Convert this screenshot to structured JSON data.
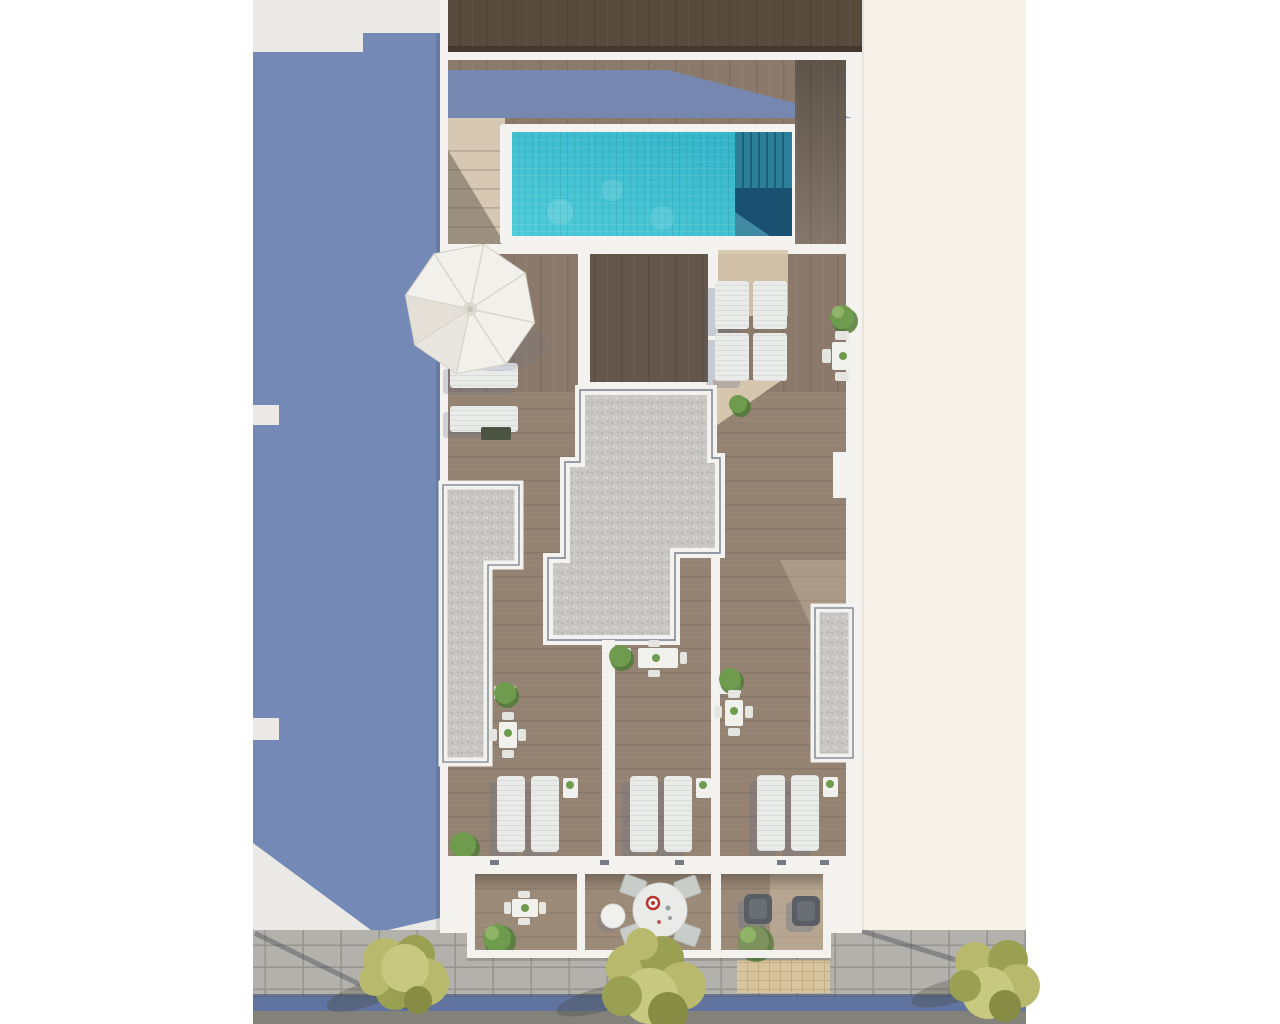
{
  "scene": {
    "description": "Aerial top-down 3D render of a residential building rooftop with swimming pool, terraces, balconies and street below",
    "objects": [
      {
        "name": "swimming-pool",
        "count": 1
      },
      {
        "name": "pool-steps-ledge",
        "count": 1
      },
      {
        "name": "stair-flight",
        "count": 1
      },
      {
        "name": "parasol",
        "count": 1
      },
      {
        "name": "sun-lounger",
        "count": 12
      },
      {
        "name": "gravel-roof-section",
        "count": 1
      },
      {
        "name": "gravel-planter-strip",
        "count": 2
      },
      {
        "name": "terrace",
        "count": 3
      },
      {
        "name": "balcony",
        "count": 3
      },
      {
        "name": "round-dining-table",
        "count": 1
      },
      {
        "name": "square-dining-table",
        "count": 5
      },
      {
        "name": "lounge-chair-dark",
        "count": 2
      },
      {
        "name": "potted-plant",
        "count": 10
      },
      {
        "name": "street-tree",
        "count": 3
      },
      {
        "name": "sidewalk",
        "count": 1
      },
      {
        "name": "street-asphalt",
        "count": 1
      },
      {
        "name": "adjacent-building-shadow",
        "count": 1
      }
    ]
  },
  "palette": {
    "page_bg": "#ffffff",
    "left_col": "#eae9e6",
    "shadow_blue": "#7489b6",
    "wall": "#f3f2ee",
    "dark_wood": "#584a3d",
    "dark_wood2": "#63564a",
    "deck_wood": "#8b7a6b",
    "terrace_wood": "#9c8a78",
    "beige": "#d7c6ae",
    "stairs": "#d7c8b3",
    "pool_light": "#4fccd9",
    "pool_main": "#2fb1c5",
    "pool_ledge": "#2b7f98",
    "pool_ledge_line": "#1d6078",
    "pool_deep": "#1a5070",
    "coping": "#f4f3f0",
    "gravel": "#c7c6c2",
    "gravel_dot_dark": "#aeadaa",
    "gravel_dot_light": "#dbdad6",
    "edge_navy": "#3e4e64",
    "cream": "#f7f2e9",
    "sidewalk": "#b3b1ab",
    "paver_joint": "#96948f",
    "blue_strip": "#61749f",
    "asphalt": "#82817a",
    "tan_tile": "#d8c5a0",
    "tan_joint": "#c2ae84",
    "lounger": "#e9ebe9",
    "chair_dark": "#5a5e64",
    "plant_green": "#6f9b4e",
    "plant_green_dark": "#4f7a36",
    "plant_green_light": "#8fb468",
    "tree_yellow": "#b8b96c",
    "tree_yellow_dark": "#9aa052",
    "tree_yellow_light": "#c8c980",
    "parasol": "#f2f0ea",
    "parasol_shade": "#d8d4c8",
    "cast_shadow": "#62708f"
  }
}
